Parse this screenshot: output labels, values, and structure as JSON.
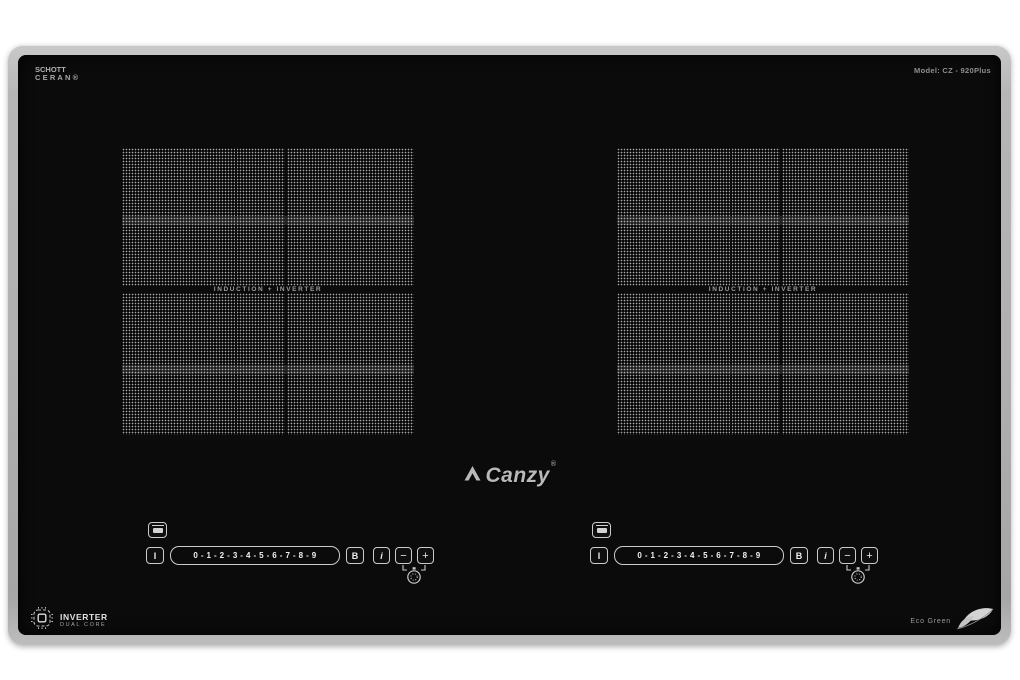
{
  "product": {
    "surface_brand": {
      "line1": "SCHOTT",
      "line2": "CERAN®"
    },
    "model_label": "Model: CZ - 920Plus",
    "logo": {
      "text": "Canzy",
      "registered": "®"
    },
    "zone_label": "INDUCTION + INVERTER",
    "controls": {
      "power_key": "I",
      "power_scale": "0 - 1 - 2 - 3 - 4 - 5 - 6 - 7 - 8 - 9",
      "booster_key": "B",
      "info_key": "i",
      "minus_key": "−",
      "plus_key": "+"
    },
    "badges": {
      "inverter_title": "INVERTER",
      "inverter_subtitle": "DUAL CORE",
      "eco_label": "Eco Green"
    },
    "colors": {
      "frame": "#b0b0b0",
      "glass": "#0b0b0c",
      "dot_pattern": "#a8a8a8",
      "control_outline": "#cbcbcb"
    },
    "icons": {
      "logo_mark": "chevron-peak-icon",
      "pan_indicator": "pan-icon",
      "timer": "stopwatch-icon",
      "inverter_chip": "chip-icon",
      "eco_leaf": "leaf-icon"
    }
  }
}
